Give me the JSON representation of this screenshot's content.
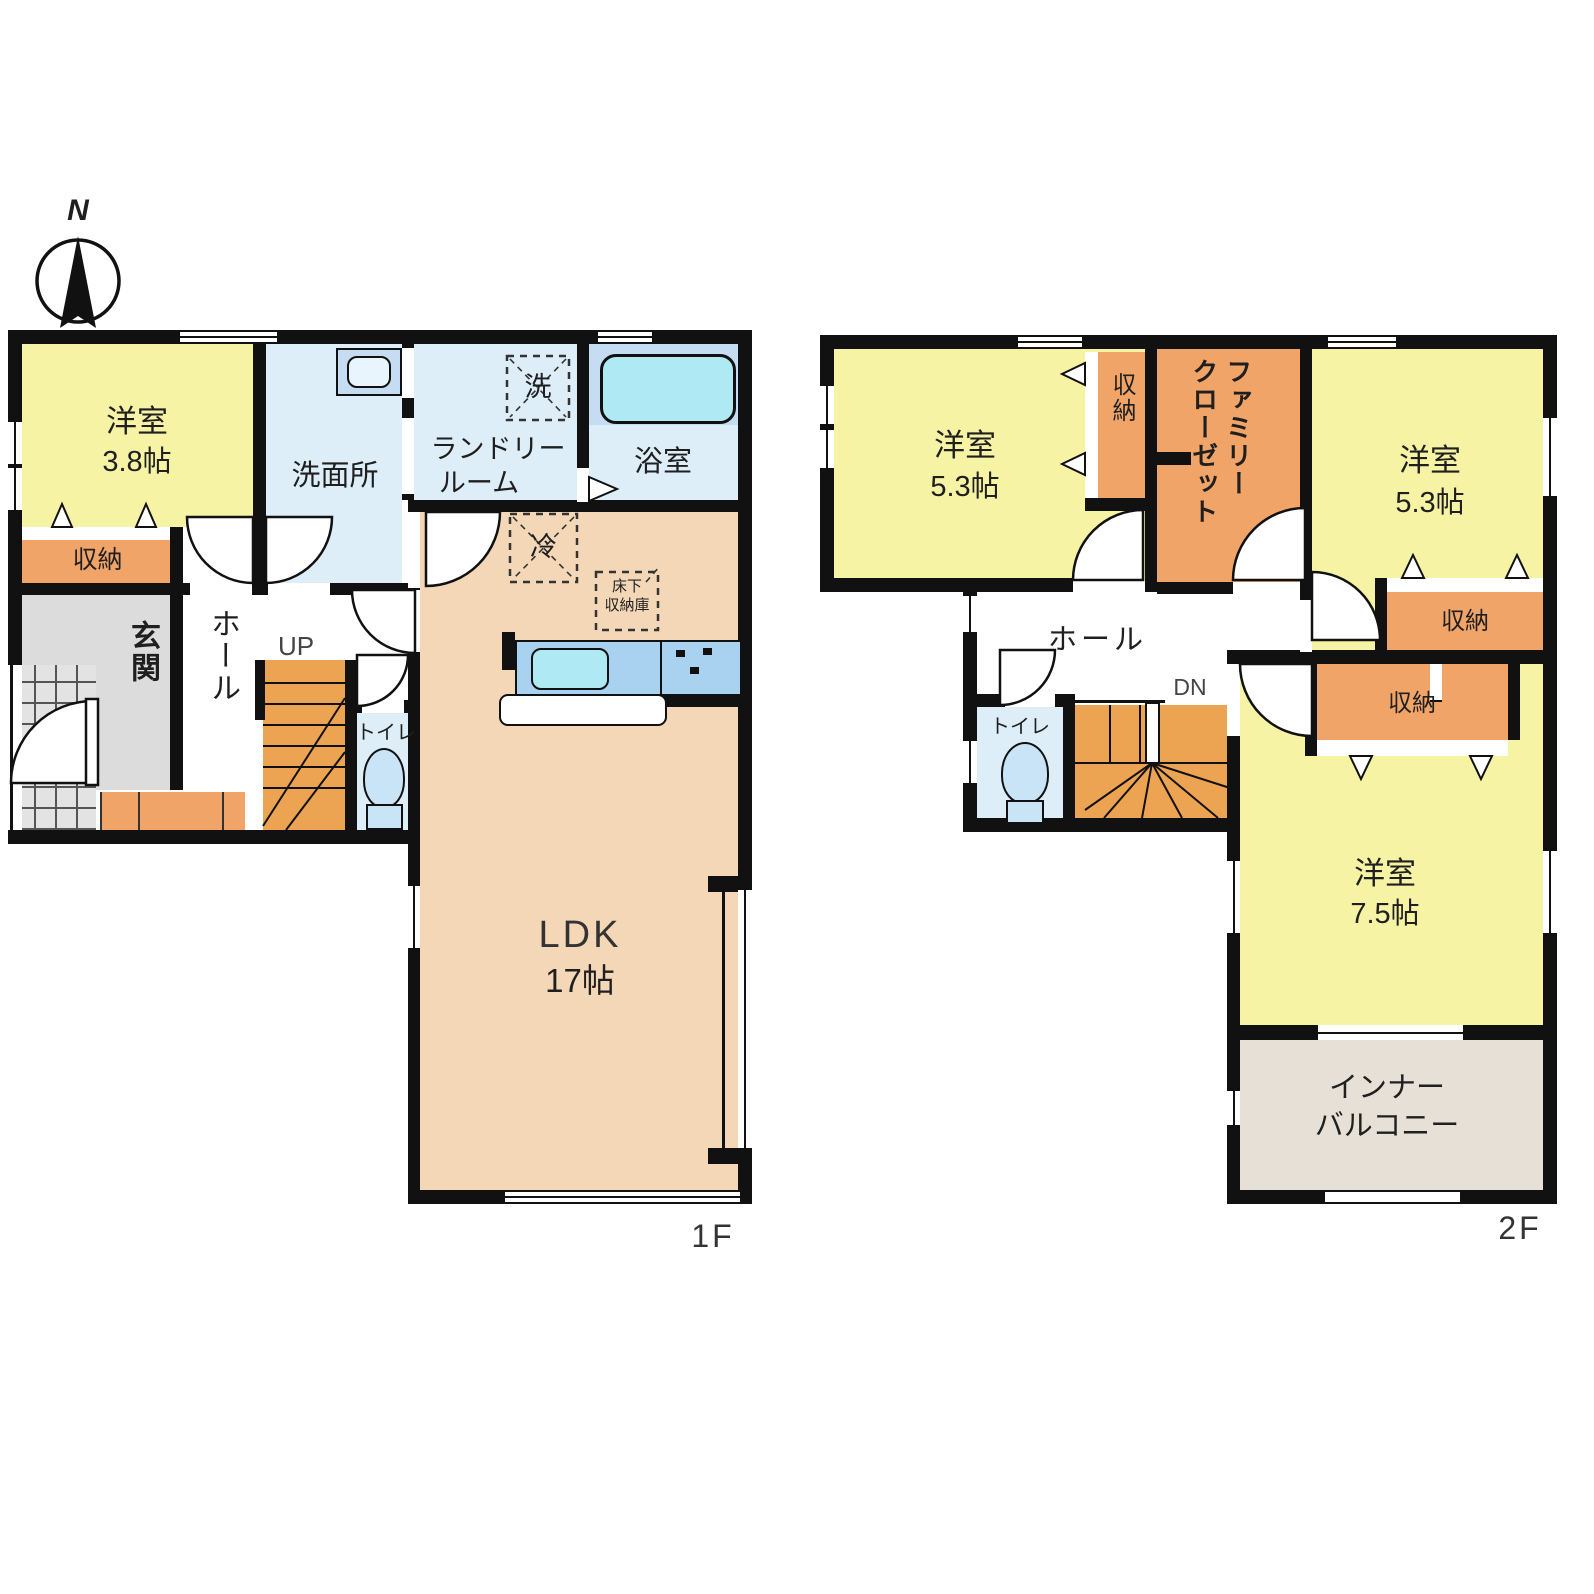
{
  "compass": {
    "north": "N"
  },
  "floor1": {
    "floor_label": "1F",
    "western_room": {
      "name": "洋室",
      "size": "3.8帖"
    },
    "storage": "収納",
    "washroom": "洗面所",
    "laundry_line1": "ランドリー",
    "laundry_line2": "ルーム",
    "washer_box": "洗",
    "bathroom": "浴室",
    "fridge_box": "冷",
    "underfloor_line1": "床下",
    "underfloor_line2": "収納庫",
    "entrance": "玄関",
    "hall": "ホール",
    "stairs_up": "UP",
    "toilet": "トイレ",
    "ldk": {
      "name": "LDK",
      "size": "17帖"
    }
  },
  "floor2": {
    "floor_label": "2F",
    "western_room_left": {
      "name": "洋室",
      "size": "5.3帖"
    },
    "storage_top": "収納",
    "family_closet": "ファミリー\nクローゼット",
    "western_room_right": {
      "name": "洋室",
      "size": "5.3帖"
    },
    "storage_right": "収納",
    "storage_mid": "収納",
    "hall": "ホール",
    "stairs_down": "DN",
    "toilet": "トイレ",
    "western_room_75": {
      "name": "洋室",
      "size": "7.5帖"
    },
    "balcony_line1": "インナー",
    "balcony_line2": "バルコニー"
  },
  "colors": {
    "wall": "#111111",
    "text": "#1f1f1f",
    "yellow": "#F7F3A4",
    "orange": "#F0A468",
    "stair": "#ECA452",
    "lightblue": "#DDEEF9",
    "bathblue": "#C5DCF2",
    "tub": "#AEE9F4",
    "counter": "#A9D2F0",
    "peach": "#F4D7B7",
    "gray": "#DCDCDC",
    "balcony": "#E6E0D6"
  }
}
